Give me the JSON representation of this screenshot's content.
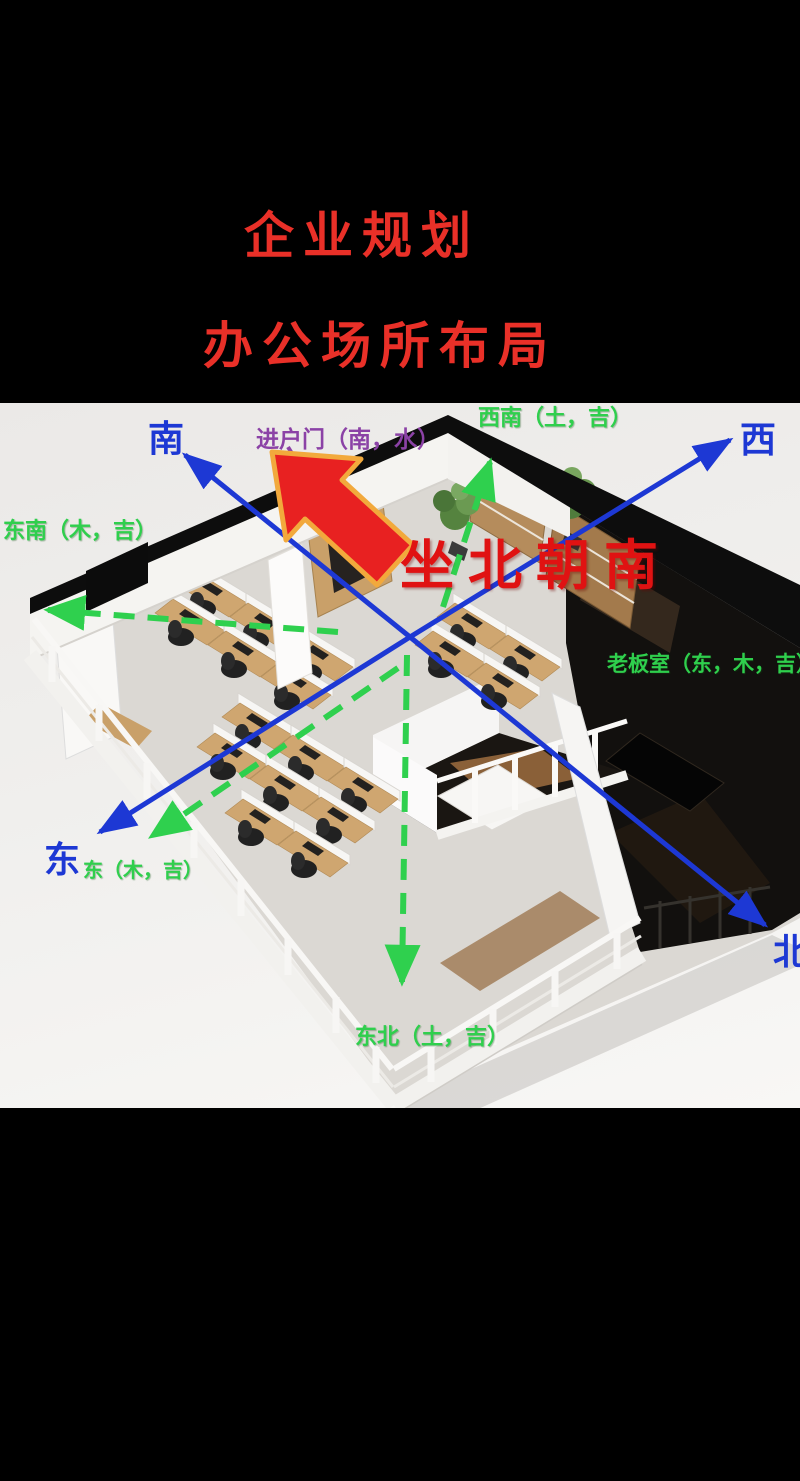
{
  "header": {
    "line1": "企业规划",
    "line2": "办公场所布局",
    "title_color": "#e93028"
  },
  "photo": {
    "compass": {
      "south": "南",
      "west": "西",
      "east": "东",
      "north": "北"
    },
    "labels": {
      "entrance_door": "进户门（南，水）",
      "southwest": "西南（土，吉）",
      "southeast": "东南（木，吉）",
      "east_detail": "东（木，吉）",
      "northeast": "东北（土，吉）",
      "boss_office": "老板室（东，木，吉）",
      "orientation": "坐北朝南"
    },
    "colors": {
      "compass_blue": "#1d38d4",
      "auspicious_green": "#2fcf4d",
      "entrance_purple": "#8b42a6",
      "orientation_red": "#e01212",
      "pointer_arrow_fill": "#e82121",
      "pointer_arrow_outline": "#f2a93c"
    }
  }
}
